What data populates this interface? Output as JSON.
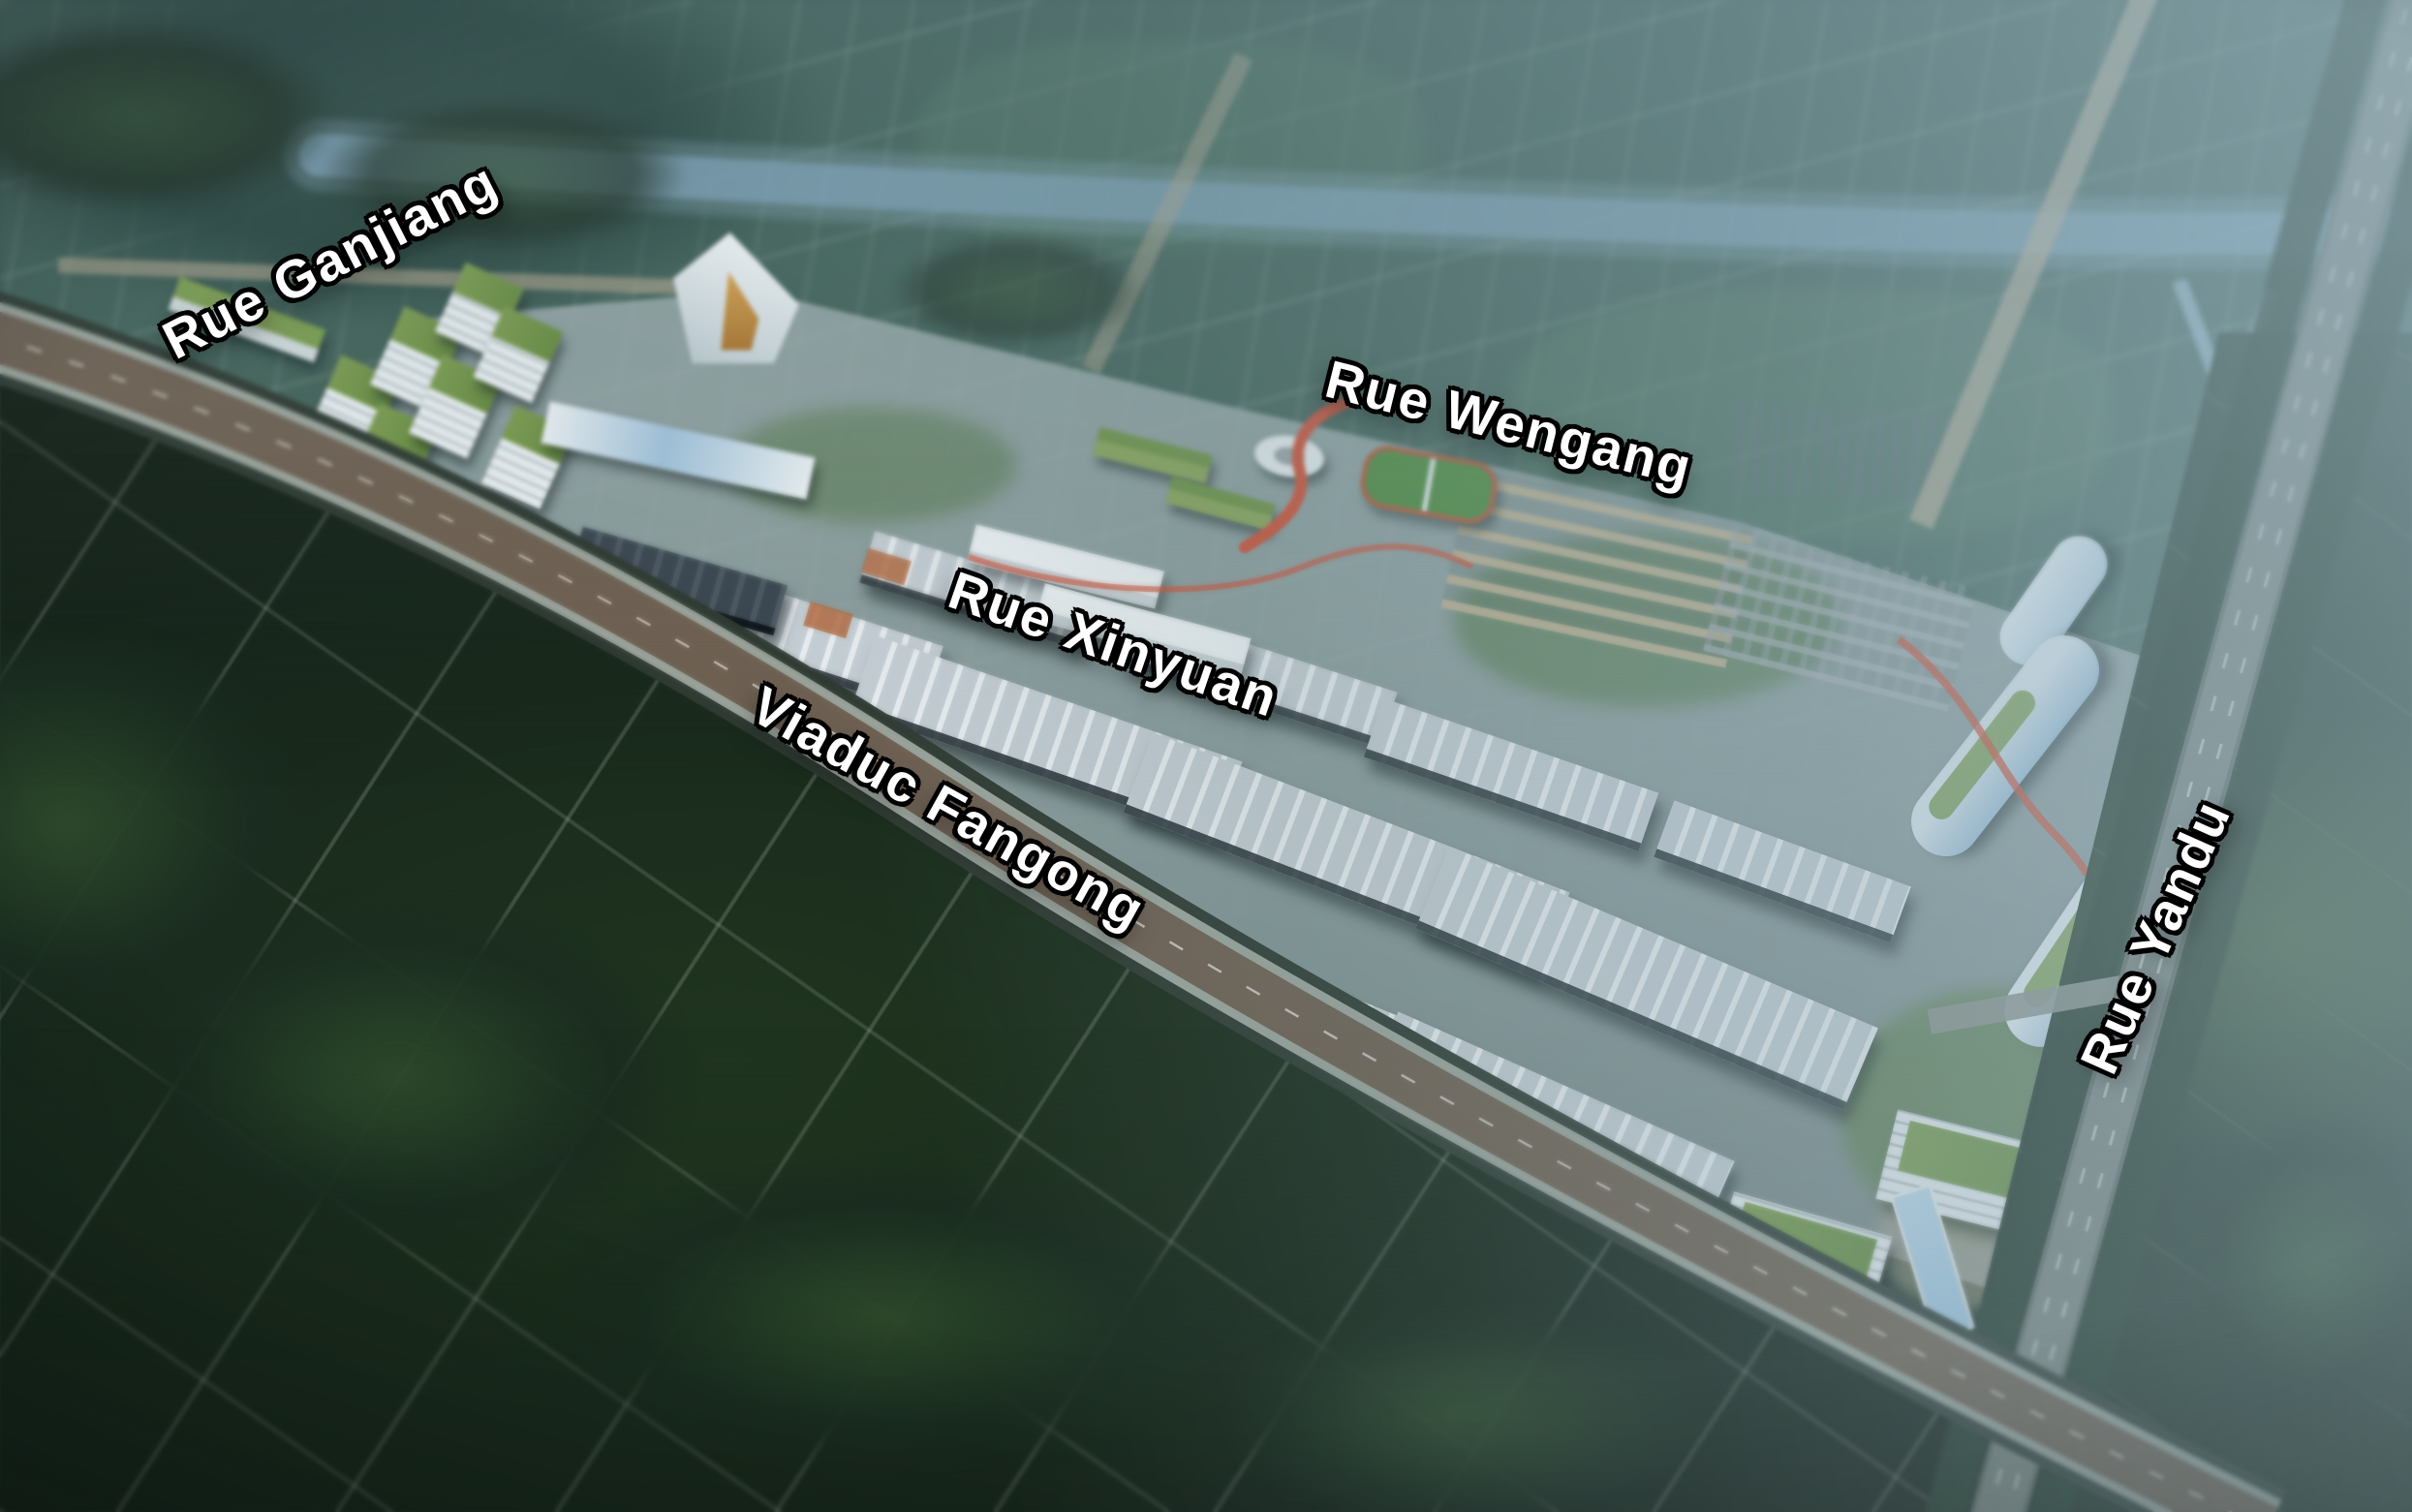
{
  "scene": {
    "street_labels": [
      {
        "id": "rue-ganjiang",
        "text": "Rue Ganjiang"
      },
      {
        "id": "rue-wengang",
        "text": "Rue Wengang"
      },
      {
        "id": "rue-xinyuan",
        "text": "Rue Xinyuan"
      },
      {
        "id": "viaduc-fangong",
        "text": "Viaduc Fangong"
      },
      {
        "id": "rue-yandu",
        "text": "Rue Yandu"
      }
    ],
    "colors": {
      "label_text": "#ffffff",
      "label_outline": "#000000",
      "haze_blue": "#8fa7b3",
      "river_blue": "#7fa3bb",
      "forest_dark": "#17261c",
      "farmland_green": "#46665c",
      "warehouse_roof_grey": "#c3ccd2",
      "green_roof": "#7a9a4e",
      "viaduct_deck_brown": "#6e6052",
      "walkway_red": "#cf5138",
      "campus_glass_blue": "#9fc0d8",
      "residential_tan": "#c1b192",
      "rural_road_beige": "#b3a78f"
    }
  }
}
